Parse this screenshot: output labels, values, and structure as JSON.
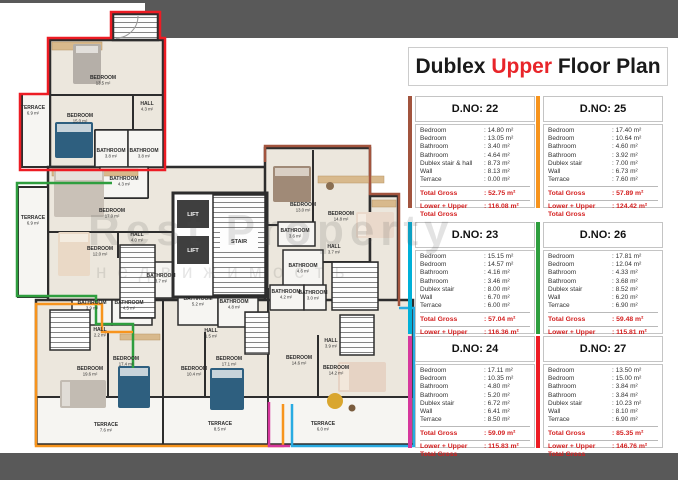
{
  "title": {
    "part1": "Dublex ",
    "highlight": "Upper",
    "part2": " Floor Plan"
  },
  "watermark": {
    "line1": "Rest Property",
    "line2": "недвижимость"
  },
  "units": {
    "u22": "#a2543e",
    "u23": "#29abe2",
    "u24": "#d6379d",
    "u25": "#f7941d",
    "u26": "#2e9e3e",
    "u27": "#ed1c24"
  },
  "cards": [
    {
      "dno": "D.NO: 22",
      "accent": "#a2543e",
      "rows": [
        [
          "Bedroom",
          ": 14.80 m²"
        ],
        [
          "Bedroom",
          ": 13.05 m²"
        ],
        [
          "Bathroom",
          ": 3.40 m²"
        ],
        [
          "Bathroom",
          ": 4.64 m²"
        ],
        [
          "Dublex stair & hall",
          ": 8.73 m²"
        ],
        [
          "Wall",
          ": 8.13 m²"
        ],
        [
          "Terrace",
          ": 0.00 m²"
        ]
      ],
      "total_label": "Total Gross",
      "total_value": ": 52.75 m²",
      "lower_label": "Lower + Upper Total Gross",
      "lower_value": ": 116.08 m²"
    },
    {
      "dno": "D.NO: 25",
      "accent": "#f7941d",
      "rows": [
        [
          "Bedroom",
          ": 17.40 m²"
        ],
        [
          "Bedroom",
          ": 10.64 m²"
        ],
        [
          "Bathroom",
          ": 4.60 m²"
        ],
        [
          "Bathroom",
          ": 3.92 m²"
        ],
        [
          "Dublex stair",
          ": 7.00 m²"
        ],
        [
          "Wall",
          ": 6.73 m²"
        ],
        [
          "Terrace",
          ": 7.60 m²"
        ]
      ],
      "total_label": "Total Gross",
      "total_value": ": 57.89 m²",
      "lower_label": "Lower + Upper Total Gross",
      "lower_value": ": 124.42 m²"
    },
    {
      "dno": "D.NO: 23",
      "accent": "#00b0d8",
      "rows": [
        [
          "Bedroom",
          ": 15.15 m²"
        ],
        [
          "Bedroom",
          ": 14.57 m²"
        ],
        [
          "Bathroom",
          ": 4.16 m²"
        ],
        [
          "Bathroom",
          ": 3.46 m²"
        ],
        [
          "Dublex stair",
          ": 8.00 m²"
        ],
        [
          "Wall",
          ": 6.70 m²"
        ],
        [
          "Terrace",
          ": 6.00 m²"
        ]
      ],
      "total_label": "Total Gross",
      "total_value": ": 57.04 m²",
      "lower_label": "Lower + Upper Total Gross",
      "lower_value": ": 116.36 m²"
    },
    {
      "dno": "D.NO: 26",
      "accent": "#2e9e3e",
      "rows": [
        [
          "Bedroom",
          ": 17.81 m²"
        ],
        [
          "Bedroom",
          ": 12.04 m²"
        ],
        [
          "Bathroom",
          ": 4.33 m²"
        ],
        [
          "Bathroom",
          ": 3.68 m²"
        ],
        [
          "Dublex stair",
          ": 8.52 m²"
        ],
        [
          "Wall",
          ": 6.20 m²"
        ],
        [
          "Terrace",
          ": 6.90 m²"
        ]
      ],
      "total_label": "Total Gross",
      "total_value": ": 59.48 m²",
      "lower_label": "Lower + Upper Total Gross",
      "lower_value": ": 115.81 m²"
    },
    {
      "dno": "D.NO: 24",
      "accent": "#d6379d",
      "rows": [
        [
          "Bedroom",
          ": 17.11 m²"
        ],
        [
          "Bedroom",
          ": 10.35 m²"
        ],
        [
          "Bathroom",
          ": 4.80 m²"
        ],
        [
          "Bathroom",
          ": 5.20 m²"
        ],
        [
          "Dublex stair",
          ": 6.72 m²"
        ],
        [
          "Wall",
          ": 6.41 m²"
        ],
        [
          "Terrace",
          ": 8.50 m²"
        ]
      ],
      "total_label": "Total Gross",
      "total_value": ": 59.09 m²",
      "lower_label": "Lower + Upper Total Gross",
      "lower_value": ": 115.83 m²"
    },
    {
      "dno": "D.NO: 27",
      "accent": "#ed1c24",
      "rows": [
        [
          "Bedroom",
          ": 13.50 m²"
        ],
        [
          "Bedroom",
          ": 15.00 m²"
        ],
        [
          "Bathroom",
          ": 3.84 m²"
        ],
        [
          "Bathroom",
          ": 3.84 m²"
        ],
        [
          "Dublex stair",
          ": 10.23 m²"
        ],
        [
          "Wall",
          ": 8.10 m²"
        ],
        [
          "Terrace",
          ": 6.90 m²"
        ]
      ],
      "total_label": "Total Gross",
      "total_value": ": 85.35 m²",
      "lower_label": "Lower + Upper Total Gross",
      "lower_value": ": 146.76 m²"
    }
  ],
  "plan": {
    "core": {
      "lift": "LIFT",
      "stair": "STAIR"
    },
    "rooms": [
      {
        "name": "TERRACE",
        "area": "6.9 m²"
      },
      {
        "name": "BEDROOM",
        "area": "13.5 m²"
      },
      {
        "name": "HALL",
        "area": "4.3 m²"
      },
      {
        "name": "BEDROOM",
        "area": "15.0 m²"
      },
      {
        "name": "BATHROOM",
        "area": "3.8 m²"
      },
      {
        "name": "BATHROOM",
        "area": "3.8 m²"
      },
      {
        "name": "BATHROOM",
        "area": "4.3 m²"
      },
      {
        "name": "BEDROOM",
        "area": "17.0 m²"
      },
      {
        "name": "TERRACE",
        "area": "6.9 m²"
      },
      {
        "name": "HALL",
        "area": "4.0 m²"
      },
      {
        "name": "BEDROOM",
        "area": "12.0 m²"
      },
      {
        "name": "BATHROOM",
        "area": "3.7 m²"
      },
      {
        "name": "BEDROOM",
        "area": "13.0 m²"
      },
      {
        "name": "BEDROOM",
        "area": "14.8 m²"
      },
      {
        "name": "BATHROOM",
        "area": "3.6 m²"
      },
      {
        "name": "HALL",
        "area": "3.7 m²"
      },
      {
        "name": "BATHROOM",
        "area": "4.6 m²"
      },
      {
        "name": "BATHROOM",
        "area": "3.9 m²"
      },
      {
        "name": "BATHROOM",
        "area": "4.5 m²"
      },
      {
        "name": "BATHROOM",
        "area": "5.2 m²"
      },
      {
        "name": "BATHROOM",
        "area": "4.8 m²"
      },
      {
        "name": "BATHROOM",
        "area": "4.2 m²"
      },
      {
        "name": "BATHROOM",
        "area": "3.0 m²"
      },
      {
        "name": "HALL",
        "area": "2.2 m²"
      },
      {
        "name": "HALL",
        "area": "1.5 m²"
      },
      {
        "name": "HALL",
        "area": "3.9 m²"
      },
      {
        "name": "BEDROOM",
        "area": "19.6 m²"
      },
      {
        "name": "BEDROOM",
        "area": "17.4 m²"
      },
      {
        "name": "BEDROOM",
        "area": "10.4 m²"
      },
      {
        "name": "BEDROOM",
        "area": "17.1 m²"
      },
      {
        "name": "BEDROOM",
        "area": "14.6 m²"
      },
      {
        "name": "BEDROOM",
        "area": "14.2 m²"
      },
      {
        "name": "TERRACE",
        "area": "7.6 m²"
      },
      {
        "name": "TERRACE",
        "area": "8.5 m²"
      },
      {
        "name": "TERRACE",
        "area": "6.0 m²"
      }
    ]
  }
}
